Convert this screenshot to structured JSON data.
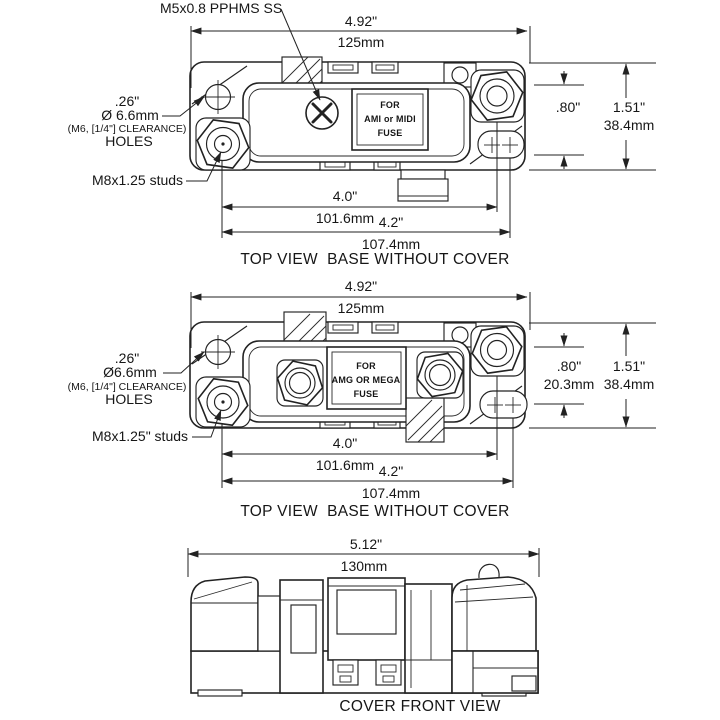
{
  "colors": {
    "background": "#ffffff",
    "line": "#222222",
    "text": "#161616"
  },
  "drawing": {
    "view1": {
      "screw_callout": "M5x0.8 PPHMS SS",
      "width_in": "4.92\"",
      "width_mm": "125mm",
      "hole_in": ".26\"",
      "hole_mm": "Ø 6.6mm",
      "hole_clearance": "(M6, [1/4\"] CLEARANCE)",
      "hole_word": "HOLES",
      "stud_callout": "M8x1.25 studs",
      "label_line1": "FOR",
      "label_line2": "AMI or MIDI",
      "label_line3": "FUSE",
      "offset_in": ".80\"",
      "height_in": "1.51\"",
      "height_mm": "38.4mm",
      "stud_span_in": "4.0\"",
      "stud_span_mm": "101.6mm",
      "slot_span_in": "4.2\"",
      "slot_span_mm": "107.4mm",
      "caption": "TOP VIEW  BASE WITHOUT COVER"
    },
    "view2": {
      "width_in": "4.92\"",
      "width_mm": "125mm",
      "hole_in": ".26\"",
      "hole_mm": "Ø6.6mm",
      "hole_clearance": "(M6, [1/4\"] CLEARANCE)",
      "hole_word": "HOLES",
      "stud_callout": "M8x1.25\" studs",
      "label_line1": "FOR",
      "label_line2": "AMG OR MEGA",
      "label_line3": "FUSE",
      "offset_in": ".80\"",
      "offset_mm": "20.3mm",
      "height_in": "1.51\"",
      "height_mm": "38.4mm",
      "stud_span_in": "4.0\"",
      "stud_span_mm": "101.6mm",
      "slot_span_in": "4.2\"",
      "slot_span_mm": "107.4mm",
      "caption": "TOP VIEW  BASE WITHOUT COVER"
    },
    "view3": {
      "width_in": "5.12\"",
      "width_mm": "130mm",
      "caption": "COVER FRONT VIEW"
    }
  }
}
